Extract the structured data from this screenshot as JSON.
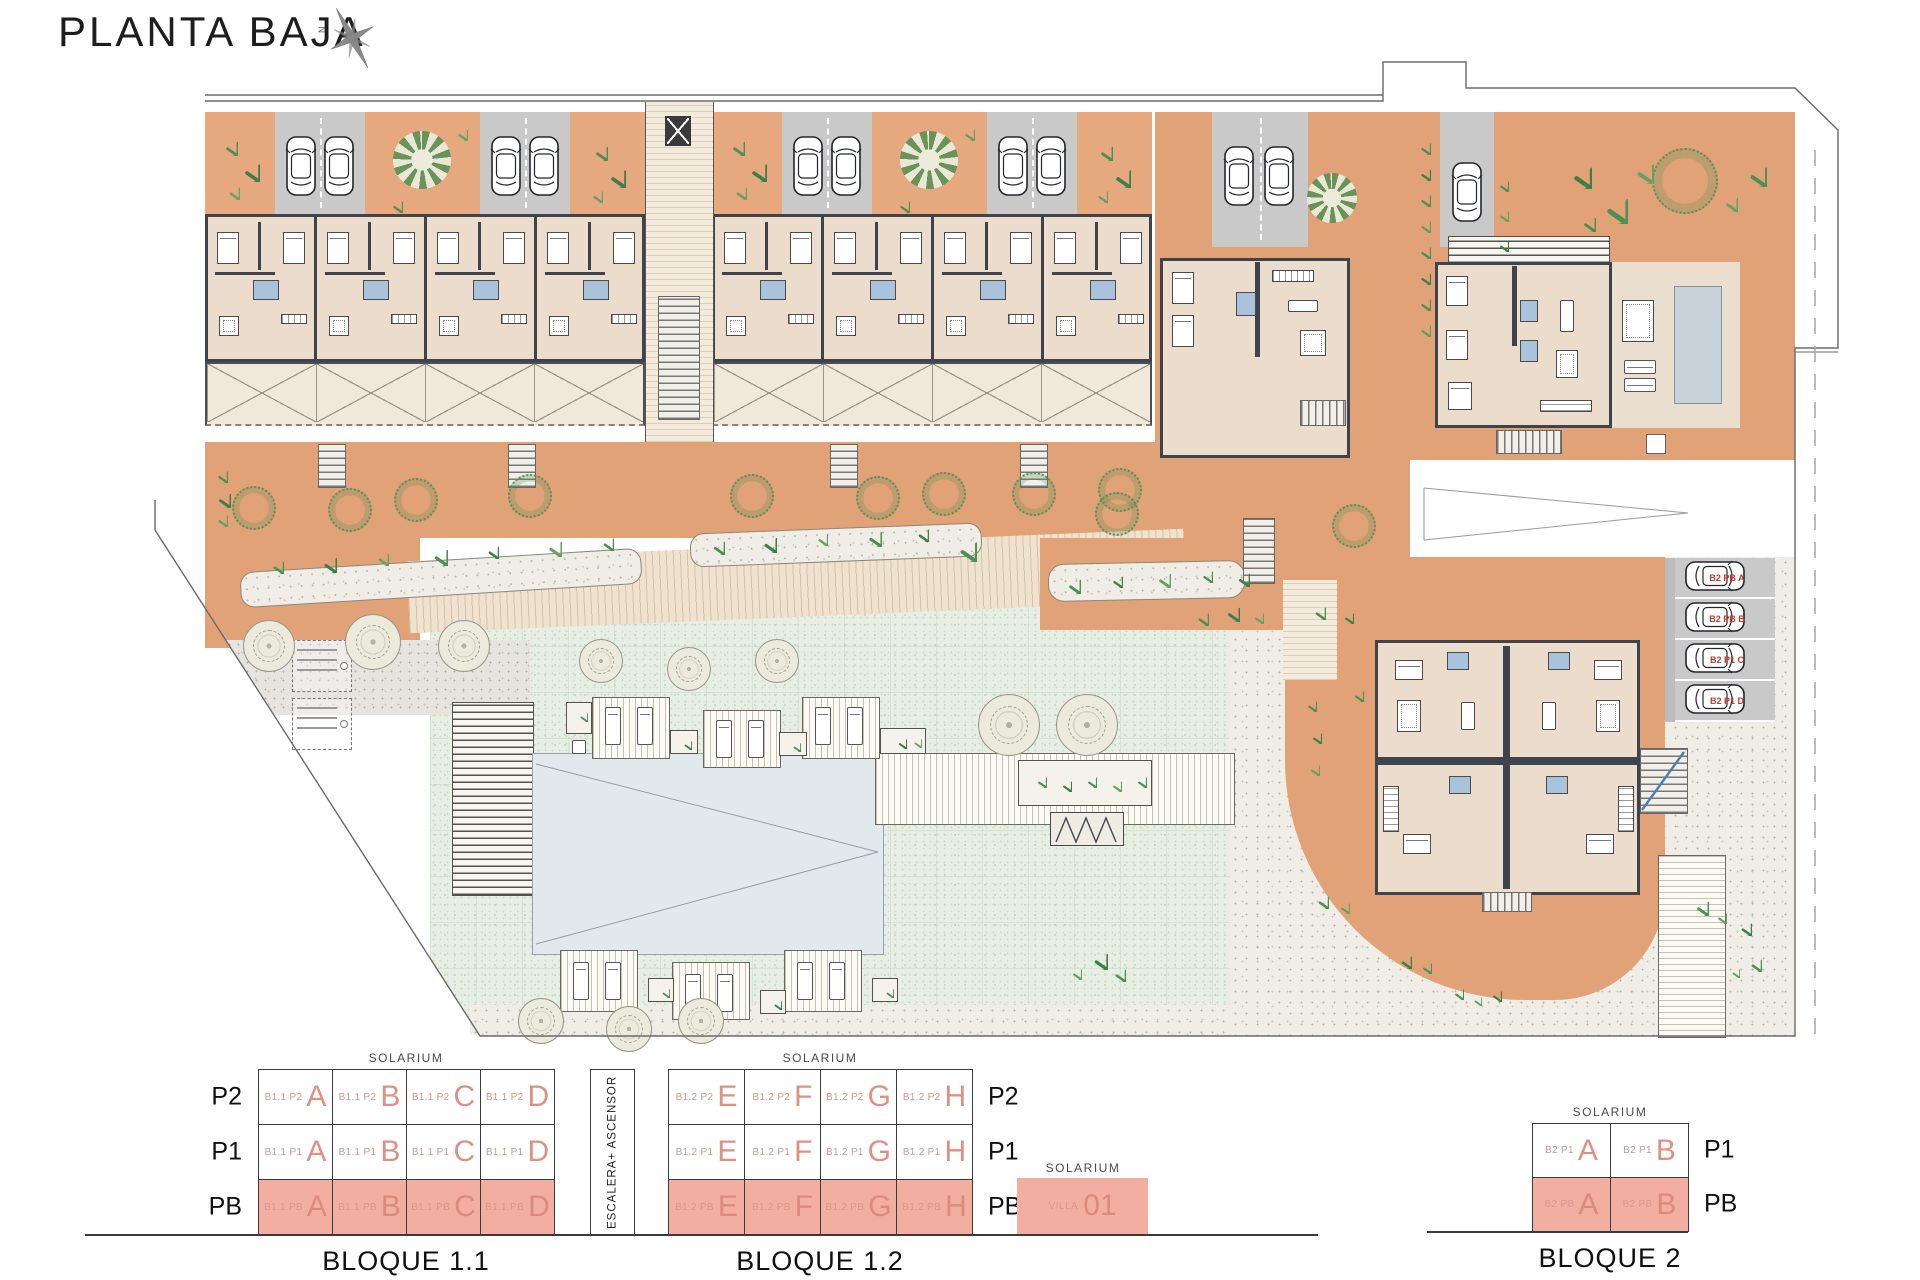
{
  "title": "PLANTA BAJA",
  "compass_label": "N",
  "schematic": {
    "solarium_label": "SOLARIUM",
    "elevator_label": "ESCALERA+ ASCENSOR",
    "blocks": [
      {
        "caption": "BLOQUE 1.1",
        "solarium": "SOLARIUM",
        "labels_side": "left",
        "floors": [
          {
            "label": "P2",
            "highlight": false,
            "cells": [
              {
                "code": "B1.1 P2",
                "unit": "A"
              },
              {
                "code": "B1.1 P2",
                "unit": "B"
              },
              {
                "code": "B1.1 P2",
                "unit": "C"
              },
              {
                "code": "B1.1 P2",
                "unit": "D"
              }
            ]
          },
          {
            "label": "P1",
            "highlight": false,
            "cells": [
              {
                "code": "B1.1 P1",
                "unit": "A"
              },
              {
                "code": "B1.1 P1",
                "unit": "B"
              },
              {
                "code": "B1.1 P1",
                "unit": "C"
              },
              {
                "code": "B1.1 P1",
                "unit": "D"
              }
            ]
          },
          {
            "label": "PB",
            "highlight": true,
            "cells": [
              {
                "code": "B1.1 PB",
                "unit": "A"
              },
              {
                "code": "B1.1 PB",
                "unit": "B"
              },
              {
                "code": "B1.1 PB",
                "unit": "C"
              },
              {
                "code": "B1.1 PB",
                "unit": "D"
              }
            ]
          }
        ]
      },
      {
        "caption": "BLOQUE 1.2",
        "solarium": "SOLARIUM",
        "labels_side": "right",
        "floors": [
          {
            "label": "P2",
            "highlight": false,
            "cells": [
              {
                "code": "B1.2 P2",
                "unit": "E"
              },
              {
                "code": "B1.2 P2",
                "unit": "F"
              },
              {
                "code": "B1.2 P2",
                "unit": "G"
              },
              {
                "code": "B1.2 P2",
                "unit": "H"
              }
            ]
          },
          {
            "label": "P1",
            "highlight": false,
            "cells": [
              {
                "code": "B1.2 P1",
                "unit": "E"
              },
              {
                "code": "B1.2 P1",
                "unit": "F"
              },
              {
                "code": "B1.2 P1",
                "unit": "G"
              },
              {
                "code": "B1.2 P1",
                "unit": "H"
              }
            ]
          },
          {
            "label": "PB",
            "highlight": true,
            "cells": [
              {
                "code": "B1.2 PB",
                "unit": "E"
              },
              {
                "code": "B1.2 PB",
                "unit": "F"
              },
              {
                "code": "B1.2 PB",
                "unit": "G"
              },
              {
                "code": "B1.2 PB",
                "unit": "H"
              }
            ]
          }
        ]
      },
      {
        "caption": "BLOQUE 2",
        "solarium": "SOLARIUM",
        "labels_side": "right",
        "floors": [
          {
            "label": "P1",
            "highlight": false,
            "cells": [
              {
                "code": "B2 P1",
                "unit": "A"
              },
              {
                "code": "B2 P1",
                "unit": "B"
              }
            ]
          },
          {
            "label": "PB",
            "highlight": true,
            "cells": [
              {
                "code": "B2 PB",
                "unit": "A"
              },
              {
                "code": "B2 PB",
                "unit": "B"
              }
            ]
          }
        ]
      }
    ],
    "villa": {
      "solarium": "SOLARIUM",
      "name": "VILLA",
      "number": "01"
    }
  },
  "plan": {
    "parking_spaces": [
      {
        "label": "B2 PB A"
      },
      {
        "label": "B2 PB B"
      },
      {
        "label": "B2 P1 C"
      },
      {
        "label": "B2 P1 D"
      }
    ]
  },
  "colors": {
    "terracotta": "#E2A277",
    "schematic_pink": "#F2AEA1",
    "unit_letter_salmon": "#DE9183",
    "parking_label_red": "#C23B32",
    "pool_blue": "#E2E9EC",
    "bath_blue": "#A9C3DC"
  }
}
